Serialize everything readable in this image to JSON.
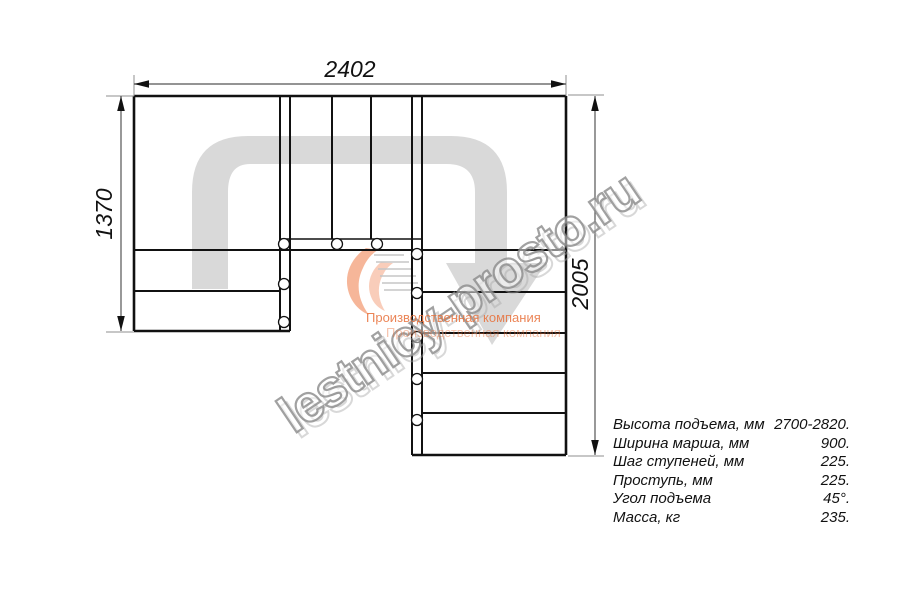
{
  "dimensions": {
    "width_top": "2402",
    "height_left": "1370",
    "height_right": "2005"
  },
  "spec_table": {
    "rows": [
      {
        "label": "Высота подъема, мм",
        "value": "2700-2820."
      },
      {
        "label": "Ширина марша, мм",
        "value": "900."
      },
      {
        "label": "Шаг ступеней, мм",
        "value": "225."
      },
      {
        "label": "Проступь, мм",
        "value": "225."
      },
      {
        "label": "Угол подъема",
        "value": "45°."
      },
      {
        "label": "Масса, кг",
        "value": "235."
      }
    ]
  },
  "watermark": {
    "text": "lestnicy-prosto.ru"
  },
  "logo": {
    "company": "Производственная компания"
  },
  "colors": {
    "line": "#111111",
    "route_arrow": "#d9d9d9",
    "watermark_stroke": "#8a8a8a",
    "logo_orange": "#e8703a",
    "extension_line": "#8f8f8f"
  }
}
